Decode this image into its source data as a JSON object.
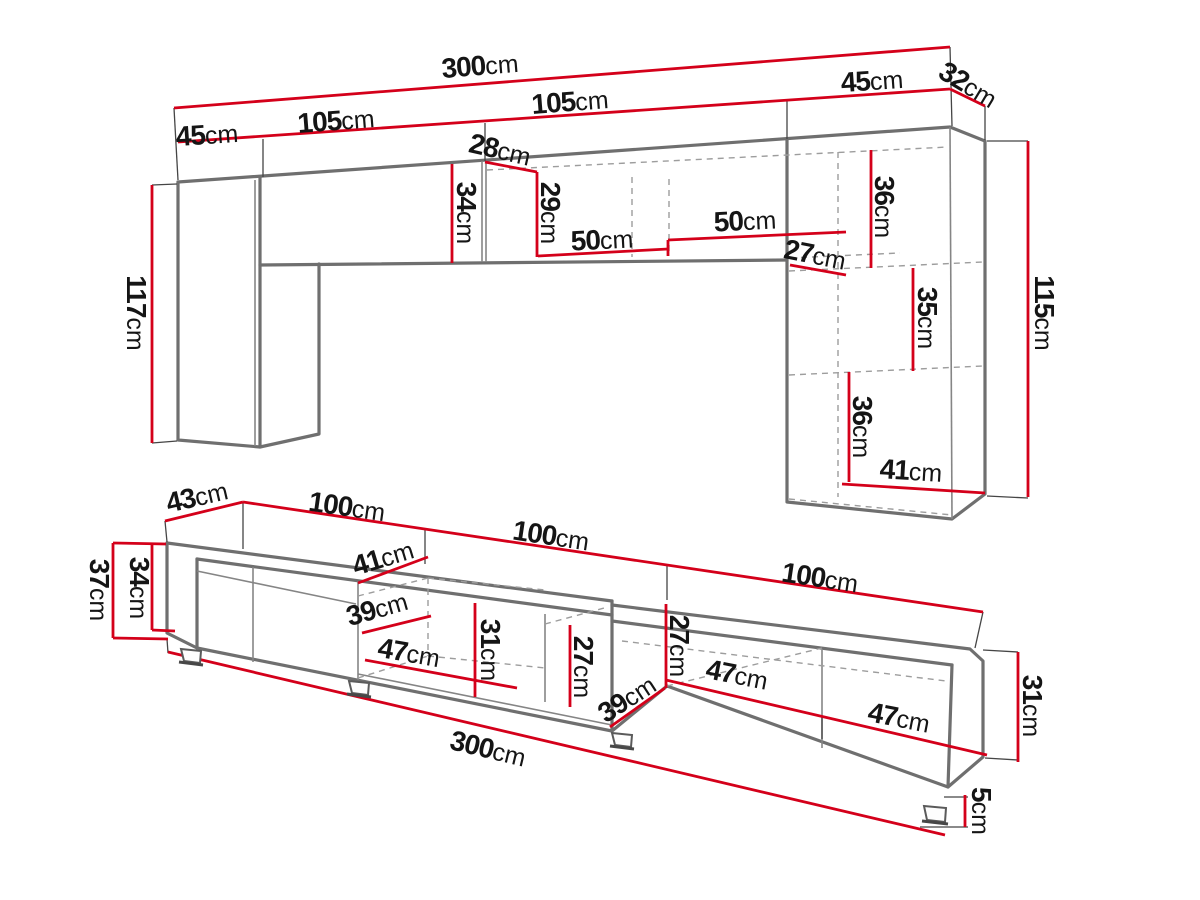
{
  "diagram_type": "furniture-dimension-drawing",
  "unit_suffix": "cm",
  "colors": {
    "dimension": "#d4001a",
    "outline": "#6f6f6f",
    "medium": "#858585",
    "dashed": "#9d9d9d",
    "tick": "#454545",
    "text": "#151515",
    "background": "#ffffff"
  },
  "wall_unit": {
    "name": "wall unit (upper)",
    "labels": [
      {
        "id": "300-top",
        "value": "300",
        "unit": "cm",
        "x": 480,
        "y": 66,
        "rot": -4.7
      },
      {
        "id": "105-left",
        "value": "105",
        "unit": "cm",
        "x": 336,
        "y": 121,
        "rot": -4.5
      },
      {
        "id": "45-left",
        "value": "45",
        "unit": "cm",
        "x": 207,
        "y": 135,
        "rot": -4
      },
      {
        "id": "105-right",
        "value": "105",
        "unit": "cm",
        "x": 570,
        "y": 102,
        "rot": -4.5
      },
      {
        "id": "45-right",
        "value": "45",
        "unit": "cm",
        "x": 872,
        "y": 81,
        "rot": -4
      },
      {
        "id": "32-depth",
        "value": "32",
        "unit": "cm",
        "x": 968,
        "y": 85,
        "rot": 31
      },
      {
        "id": "28-depth",
        "value": "28",
        "unit": "cm",
        "x": 500,
        "y": 150,
        "rot": 13
      },
      {
        "id": "34-height",
        "value": "34",
        "unit": "cm",
        "x": 466,
        "y": 213,
        "rot": 90
      },
      {
        "id": "29-height",
        "value": "29",
        "unit": "cm",
        "x": 550,
        "y": 213,
        "rot": 90
      },
      {
        "id": "50-left",
        "value": "50",
        "unit": "cm",
        "x": 602,
        "y": 240,
        "rot": -3
      },
      {
        "id": "50-right",
        "value": "50",
        "unit": "cm",
        "x": 745,
        "y": 221,
        "rot": -3
      },
      {
        "id": "27-depth",
        "value": "27",
        "unit": "cm",
        "x": 815,
        "y": 255,
        "rot": 11
      },
      {
        "id": "36-upper",
        "value": "36",
        "unit": "cm",
        "x": 884,
        "y": 207,
        "rot": 90
      },
      {
        "id": "35-middle",
        "value": "35",
        "unit": "cm",
        "x": 927,
        "y": 318,
        "rot": 90
      },
      {
        "id": "36-lower",
        "value": "36",
        "unit": "cm",
        "x": 862,
        "y": 427,
        "rot": 90
      },
      {
        "id": "41-shelf",
        "value": "41",
        "unit": "cm",
        "x": 911,
        "y": 471,
        "rot": 3.5
      },
      {
        "id": "117-height",
        "value": "117",
        "unit": "cm",
        "x": 136,
        "y": 313,
        "rot": 90
      },
      {
        "id": "115-height",
        "value": "115",
        "unit": "cm",
        "x": 1044,
        "y": 313,
        "rot": 90
      }
    ]
  },
  "tv_stand": {
    "name": "TV stand (lower)",
    "labels": [
      {
        "id": "43-depth",
        "value": "43",
        "unit": "cm",
        "x": 197,
        "y": 497,
        "rot": -13
      },
      {
        "id": "100-first",
        "value": "100",
        "unit": "cm",
        "x": 347,
        "y": 507,
        "rot": 8
      },
      {
        "id": "100-second",
        "value": "100",
        "unit": "cm",
        "x": 551,
        "y": 536,
        "rot": 8.5
      },
      {
        "id": "100-third",
        "value": "100",
        "unit": "cm",
        "x": 820,
        "y": 578,
        "rot": 8.5
      },
      {
        "id": "37-height",
        "value": "37",
        "unit": "cm",
        "x": 99,
        "y": 590,
        "rot": 90
      },
      {
        "id": "34-height",
        "value": "34",
        "unit": "cm",
        "x": 139,
        "y": 588,
        "rot": 90
      },
      {
        "id": "41-door",
        "value": "41",
        "unit": "cm",
        "x": 383,
        "y": 558,
        "rot": -17
      },
      {
        "id": "39-mid-depth",
        "value": "39",
        "unit": "cm",
        "x": 377,
        "y": 609,
        "rot": -16
      },
      {
        "id": "47-mid",
        "value": "47",
        "unit": "cm",
        "x": 409,
        "y": 653,
        "rot": 10
      },
      {
        "id": "31-mid",
        "value": "31",
        "unit": "cm",
        "x": 490,
        "y": 650,
        "rot": 90
      },
      {
        "id": "27-mid",
        "value": "27",
        "unit": "cm",
        "x": 583,
        "y": 667,
        "rot": 90
      },
      {
        "id": "27-right",
        "value": "27",
        "unit": "cm",
        "x": 679,
        "y": 646,
        "rot": 90
      },
      {
        "id": "39-right-depth",
        "value": "39",
        "unit": "cm",
        "x": 627,
        "y": 699,
        "rot": -33
      },
      {
        "id": "47-right-upper",
        "value": "47",
        "unit": "cm",
        "x": 737,
        "y": 675,
        "rot": 11
      },
      {
        "id": "47-right-lower",
        "value": "47",
        "unit": "cm",
        "x": 899,
        "y": 718,
        "rot": 11
      },
      {
        "id": "31-right",
        "value": "31",
        "unit": "cm",
        "x": 1032,
        "y": 706,
        "rot": 90
      },
      {
        "id": "5-feet",
        "value": "5",
        "unit": "cm",
        "x": 981,
        "y": 811,
        "rot": 90
      },
      {
        "id": "300-bottom",
        "value": "300",
        "unit": "cm",
        "x": 488,
        "y": 749,
        "rot": 13.5
      }
    ]
  }
}
